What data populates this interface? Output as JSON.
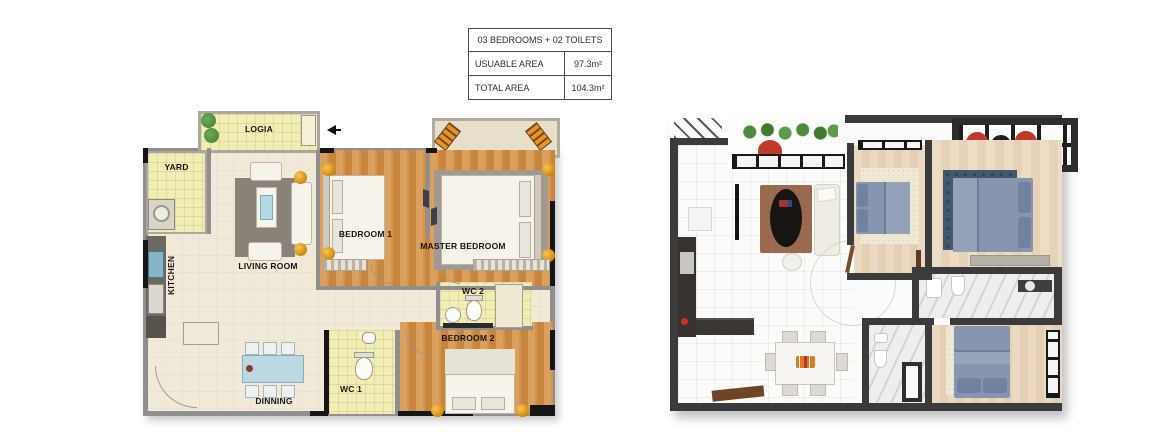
{
  "info_table": {
    "title": "03 BEDROOMS + 02 TOILETS",
    "rows": [
      {
        "label": "USUABLE AREA",
        "value": "97.3m²"
      },
      {
        "label": "TOTAL AREA",
        "value": "104.3m²"
      }
    ]
  },
  "plan_2d": {
    "name": "2D architectural floor plan",
    "rooms": {
      "logia": "LOGIA",
      "yard": "YARD",
      "kitchen": "KITCHEN",
      "living_room": "LIVING ROOM",
      "bedroom_1": "BEDROOM 1",
      "master_bedroom": "MASTER BEDROOM",
      "wc_2": "WC 2",
      "bedroom_2": "BEDROOM 2",
      "wc_1": "WC 1",
      "dinning": "DINNING"
    },
    "icons": [
      "entrance-arrow",
      "plants",
      "washer",
      "beds",
      "sofa",
      "dining-table",
      "toilets"
    ]
  },
  "plan_3d": {
    "name": "3D rendered top-down floor plan",
    "features": [
      "balcony-plants",
      "red-lounge-chairs",
      "pergola-grid",
      "blue-beds",
      "oval-coffee-table",
      "dining-table-with-logo",
      "marble-bathrooms"
    ]
  },
  "colors": {
    "wall_2d": "#8f8f8f",
    "wall_structural": "#161616",
    "floor_cream": "#f1ead9",
    "tile_yellow": "#f2edb2",
    "wood_orange": "#d2954e",
    "rug_gray": "#8a8178",
    "table_blue": "#bcd9e3",
    "accent_gold": "#d8930f",
    "wall_3d": "#3b3b3b",
    "bed_blue": "#8795ae",
    "rug_brown": "#9b6b50",
    "rug_navy": "#42586c",
    "chair_red": "#c0392b",
    "plant_green": "#4c8c3c",
    "logo_orange": "#e07a1f"
  }
}
